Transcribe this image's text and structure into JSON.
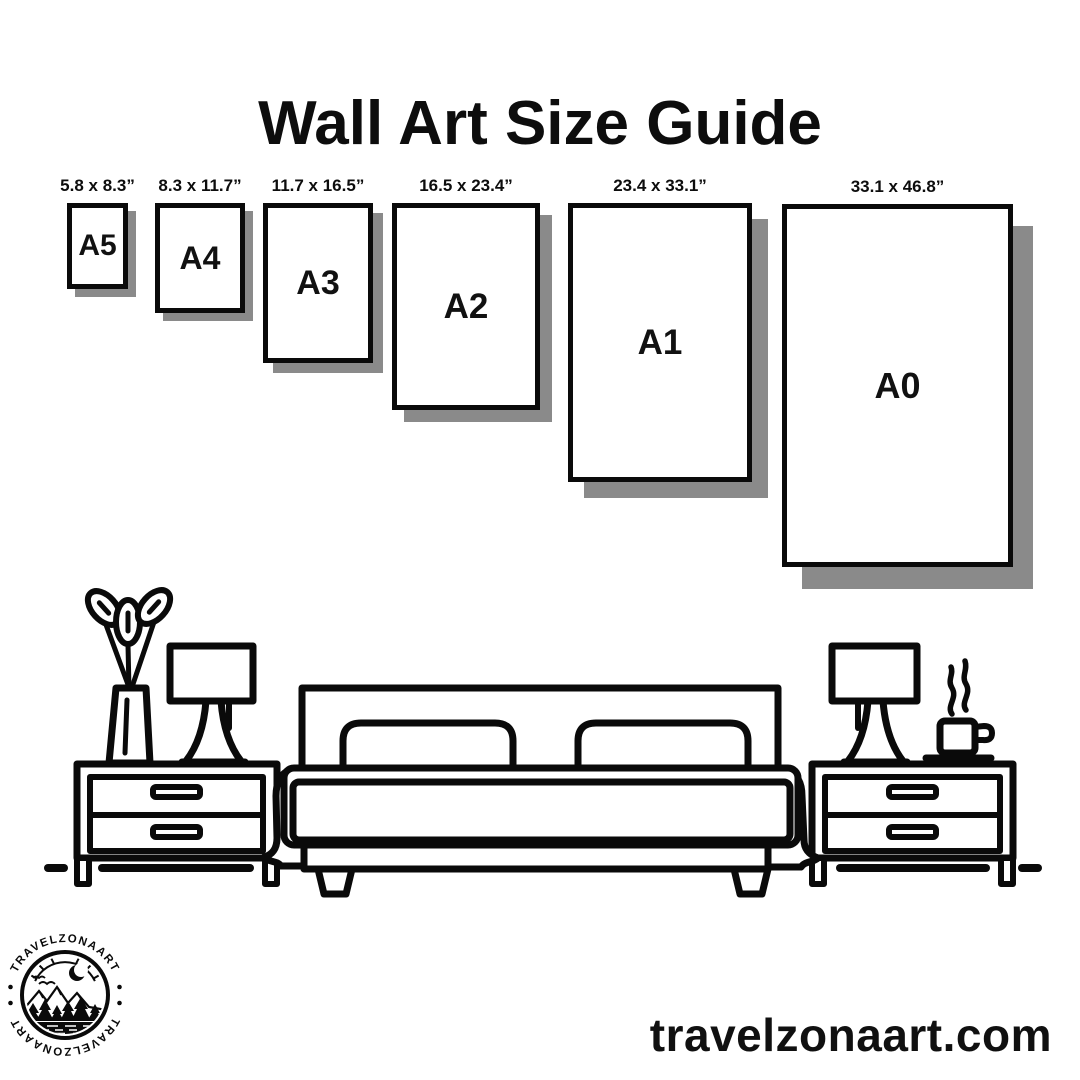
{
  "title": "Wall Art Size Guide",
  "sizes": [
    {
      "name": "A5",
      "dimensions": "5.8 x 8.3”"
    },
    {
      "name": "A4",
      "dimensions": "8.3 x 11.7”"
    },
    {
      "name": "A3",
      "dimensions": "11.7 x 16.5”"
    },
    {
      "name": "A2",
      "dimensions": "16.5 x 23.4”"
    },
    {
      "name": "A1",
      "dimensions": "23.4 x 33.1”"
    },
    {
      "name": "A0",
      "dimensions": "33.1 x 46.8”"
    }
  ],
  "logo": {
    "text": "TRAVELZONAART"
  },
  "website": "travelzonaart.com",
  "colors": {
    "ink": "#0a0a0a",
    "frame_shadow": "#8a8a8a",
    "background": "#ffffff"
  },
  "illustration": {
    "scene": "bedroom-line-art",
    "items": [
      "plant-vase",
      "table-lamp",
      "nightstand",
      "double-bed",
      "pillows",
      "coffee-cup"
    ]
  }
}
